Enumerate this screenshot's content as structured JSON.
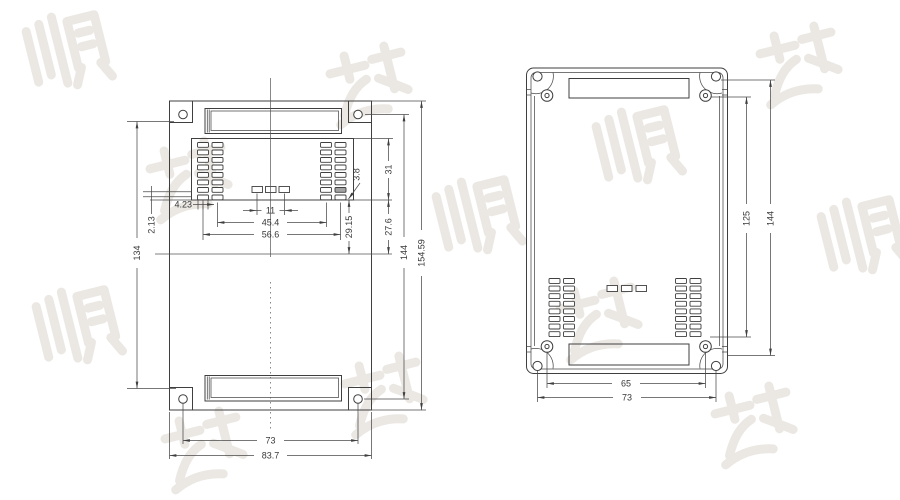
{
  "watermark": {
    "text": "顺达"
  },
  "left_view": {
    "dims": {
      "overall_height": "154.59",
      "hole_span_height": "144",
      "body_height": "134",
      "vent_top": "31",
      "vent_mid": "27.6",
      "vent_drop": "29.15",
      "slot_gap": "3.8",
      "vent_width": "56.6",
      "vent_inner_width": "45.4",
      "button_span": "11",
      "edge_offset_a": "4.23",
      "edge_offset_b": "2.13",
      "hole_span_width": "73",
      "overall_width": "83.7"
    }
  },
  "right_view": {
    "dims": {
      "boss_span_height": "125",
      "hole_span_height": "144",
      "boss_span_width": "65",
      "hole_span_width": "73"
    }
  }
}
